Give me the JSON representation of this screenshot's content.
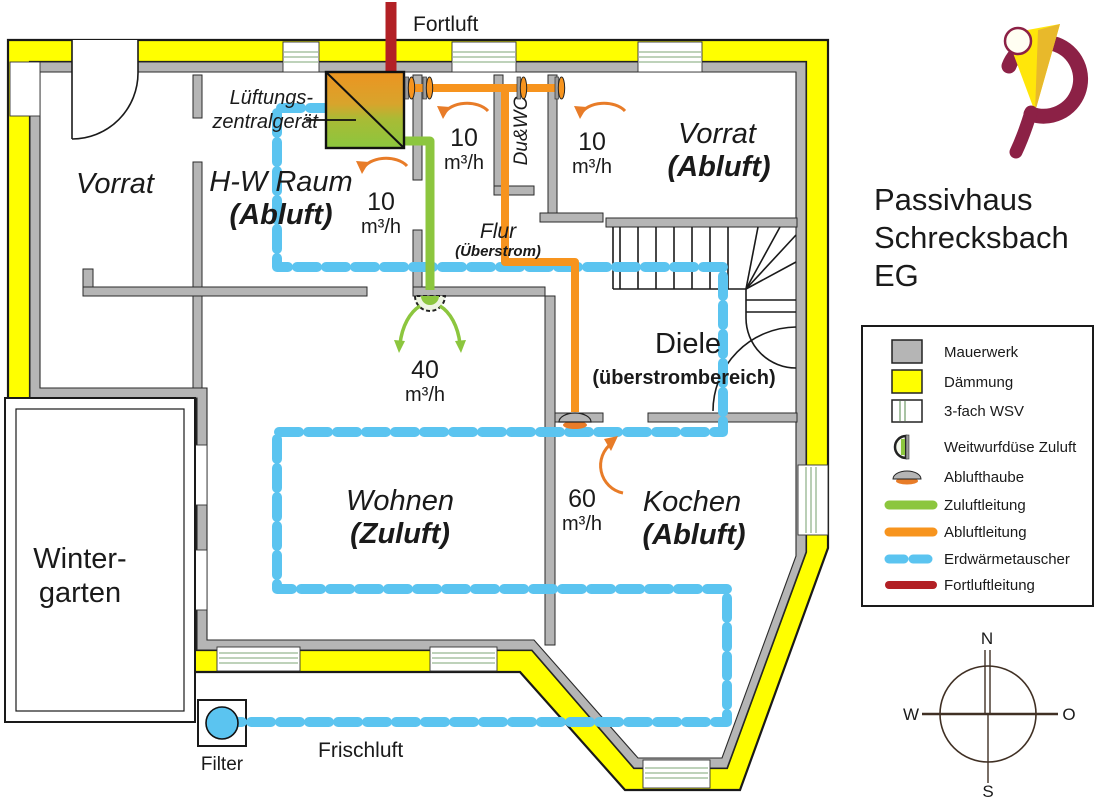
{
  "title": {
    "l1": "Passivhaus",
    "l2": "Schrecksbach",
    "l3": "EG"
  },
  "plan": {
    "fortluft_label": "Fortluft",
    "frischluft_label": "Frischluft",
    "filter_label": "Filter",
    "unit_label_1": "Lüftungs-",
    "unit_label_2": "zentralgerät",
    "rooms": {
      "vorrat_nw": "Vorrat",
      "hw_name": "H-W Raum",
      "hw_mode": "(Abluft)",
      "duwc": "Du&WC",
      "vorrat_ne": "Vorrat",
      "vorrat_ne_mode": "(Abluft)",
      "flur": "Flur",
      "flur_mode": "(Überstrom)",
      "diele": "Diele",
      "diele_mode": "(überstrombereich)",
      "wohnen": "Wohnen",
      "wohnen_mode": "(Zuluft)",
      "kochen": "Kochen",
      "kochen_mode": "(Abluft)",
      "winter_1": "Winter-",
      "winter_2": "garten"
    },
    "flows": {
      "hw": {
        "value": "10",
        "unit": "m³/h"
      },
      "wc": {
        "value": "10",
        "unit": "m³/h"
      },
      "vorrat": {
        "value": "10",
        "unit": "m³/h"
      },
      "wohnen": {
        "value": "40",
        "unit": "m³/h"
      },
      "kochen": {
        "value": "60",
        "unit": "m³/h"
      }
    }
  },
  "legend": {
    "items": [
      {
        "label": "Mauerwerk"
      },
      {
        "label": "Dämmung"
      },
      {
        "label": "3-fach WSV"
      },
      {
        "label": "Weitwurfdüse Zuluft"
      },
      {
        "label": "Ablufthaube"
      },
      {
        "label": "Zuluftleitung"
      },
      {
        "label": "Abluftleitung"
      },
      {
        "label": "Erdwärmetauscher"
      },
      {
        "label": "Fortluftleitung"
      }
    ]
  },
  "compass": {
    "n": "N",
    "s": "S",
    "w": "W",
    "o": "O"
  },
  "colors": {
    "zuluft": "#8cc63e",
    "abluft": "#f7941e",
    "abluft_text": "#e87c28",
    "erdwaermetauscher": "#5bc4f0",
    "fortluft": "#b22025",
    "daemmung": "#ffff00",
    "mauerwerk": "#b5b5b5",
    "frischluft_text": "#85ccd9"
  }
}
